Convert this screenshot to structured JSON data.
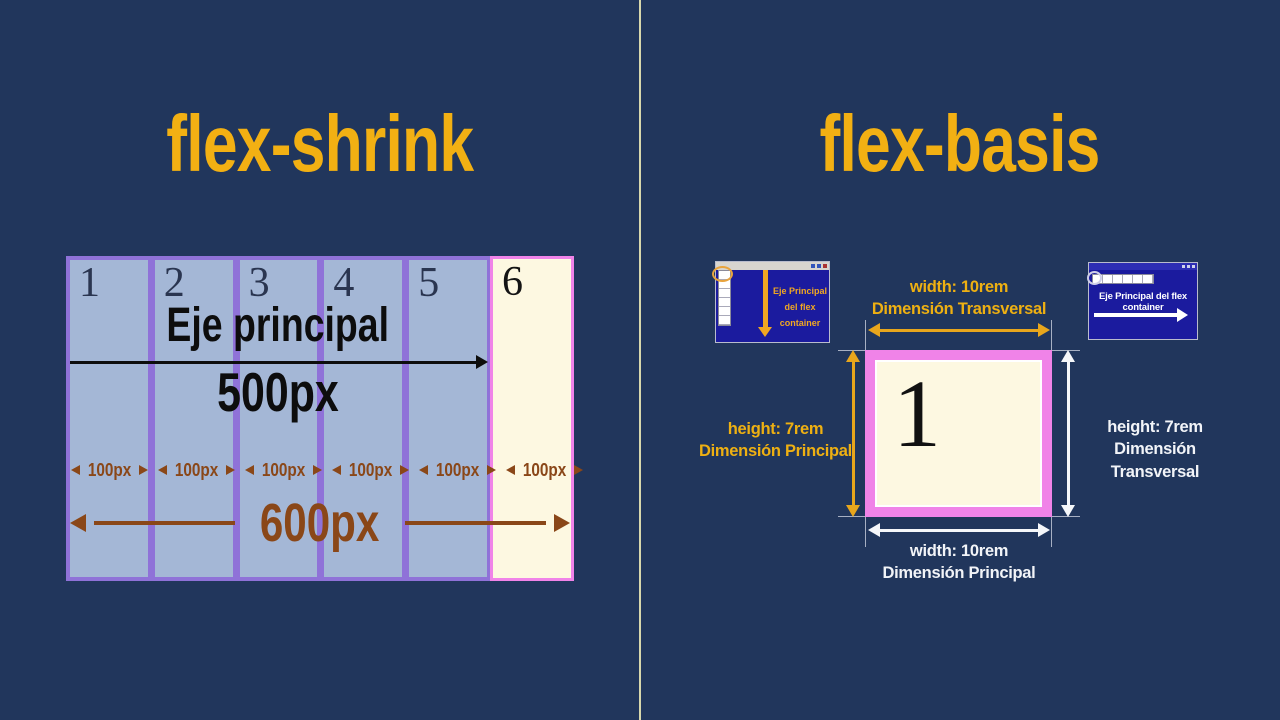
{
  "left_panel": {
    "title": "flex-shrink",
    "axis_label": "Eje principal",
    "axis_length": "500px",
    "container_total": "600px",
    "items": [
      {
        "number": "1",
        "width_label": "100px"
      },
      {
        "number": "2",
        "width_label": "100px"
      },
      {
        "number": "3",
        "width_label": "100px"
      },
      {
        "number": "4",
        "width_label": "100px"
      },
      {
        "number": "5",
        "width_label": "100px"
      },
      {
        "number": "6",
        "width_label": "100px"
      }
    ]
  },
  "right_panel": {
    "title": "flex-basis",
    "item_number": "1",
    "dim_top": {
      "line1": "width: 10rem",
      "line2": "Dimensión Transversal"
    },
    "dim_left": {
      "line1": "height: 7rem",
      "line2": "Dimensión Principal"
    },
    "dim_right": {
      "line1": "height: 7rem",
      "line2": "Dimensión Transversal"
    },
    "dim_bottom": {
      "line1": "width: 10rem",
      "line2": "Dimensión Principal"
    },
    "thumb_column_flow": {
      "caption_lines": [
        "Eje Principal",
        "del flex",
        "container"
      ]
    },
    "thumb_row_flow": {
      "caption": "Eje Principal del flex container"
    }
  },
  "colors": {
    "background": "#21365c",
    "title_yellow": "#f2b013",
    "item_blue": "#a4b7d6",
    "item_border_purple": "#8f72d8",
    "item_cream": "#fdf8e1",
    "item_border_pink": "#f083e8",
    "dimension_brown": "#8a4718",
    "dimension_yellow": "#e8a61c",
    "dimension_white": "#f2f4f8",
    "thumbnail_blue": "#1b1b9e",
    "thumbnail_yellow": "#f0a722",
    "divider_line": "#d8d8ac",
    "axis_black": "#0d0d0d"
  }
}
